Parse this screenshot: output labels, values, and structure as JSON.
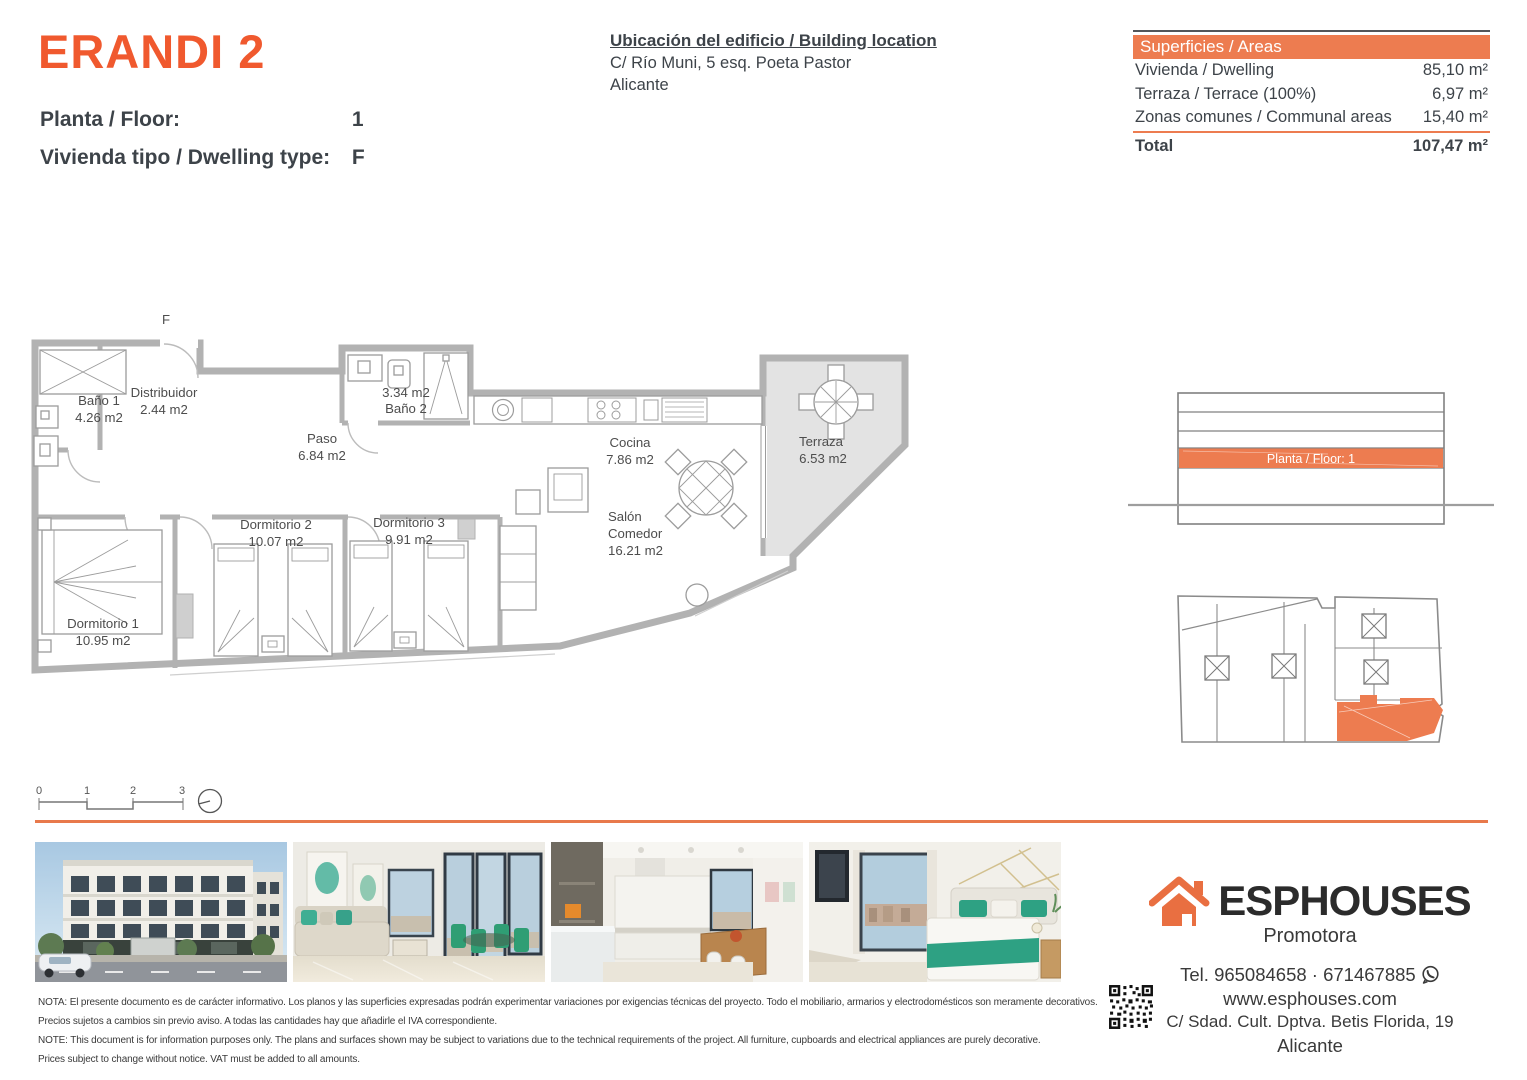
{
  "colors": {
    "accent_orange": "#F0592E",
    "table_header_orange": "#ED7C50",
    "divider_orange": "#E8794B"
  },
  "header": {
    "project_title": "ERANDI 2",
    "floor_label": "Planta / Floor:",
    "floor_value": "1",
    "dwelling_type_label": "Vivienda tipo / Dwelling type:",
    "dwelling_type_value": "F"
  },
  "location": {
    "title": "Ubicación del edificio / Building location",
    "address": "C/ Río Muni, 5 esq. Poeta Pastor",
    "city": "Alicante"
  },
  "areas_table": {
    "header": "Superficies / Areas",
    "rows": [
      {
        "label": "Vivienda / Dwelling",
        "value": "85,10 m²"
      },
      {
        "label": "Terraza / Terrace (100%)",
        "value": "6,97 m²"
      },
      {
        "label": "Zonas comunes / Communal areas",
        "value": "15,40 m²"
      }
    ],
    "total": {
      "label": "Total",
      "value": "107,47 m²"
    }
  },
  "floor_plan": {
    "type_letter": "F",
    "rooms": [
      {
        "name": "Baño 1",
        "area": "4.26 m2"
      },
      {
        "name": "Distribuidor",
        "area": "2.44 m2"
      },
      {
        "name": "Paso",
        "area": "6.84 m2"
      },
      {
        "name": "Baño 2",
        "area": "3.34 m2"
      },
      {
        "name": "Cocina",
        "area": "7.86 m2"
      },
      {
        "name": "Terraza",
        "area": "6.53 m2"
      },
      {
        "name": "Dormitorio 1",
        "area": "10.95 m2"
      },
      {
        "name": "Dormitorio 2",
        "area": "10.07 m2"
      },
      {
        "name": "Dormitorio 3",
        "area": "9.91 m2"
      },
      {
        "name": "Salón Comedor",
        "name_line1": "Salón",
        "name_line2": "Comedor",
        "area": "16.21 m2"
      }
    ],
    "scale_ticks": [
      "0",
      "1",
      "2",
      "3"
    ]
  },
  "side_panels": {
    "section_floor_label": "Planta / Floor: 1"
  },
  "footer": {
    "brand": "ESPHOUSES",
    "brand_subtitle": "Promotora",
    "phone_line": "Tel. 965084658 · 671467885",
    "website": "www.esphouses.com",
    "address": "C/ Sdad. Cult. Dptva. Betis Florida, 19",
    "city": "Alicante",
    "notes": [
      "NOTA: El presente documento es de carácter informativo. Los planos y las superficies expresadas podrán experimentar variaciones por exigencias técnicas del proyecto. Todo el mobiliario, armarios y electrodomésticos son meramente decorativos.",
      "Precios sujetos a cambios sin previo aviso. A todas las cantidades hay que añadirle el IVA correspondiente.",
      "NOTE: This document is for information purposes only. The plans and surfaces shown may be subject to variations due to the technical requirements of the project. All furniture, cupboards and electrical appliances are purely decorative.",
      "Prices subject to change without notice. VAT must be added to all amounts."
    ]
  }
}
